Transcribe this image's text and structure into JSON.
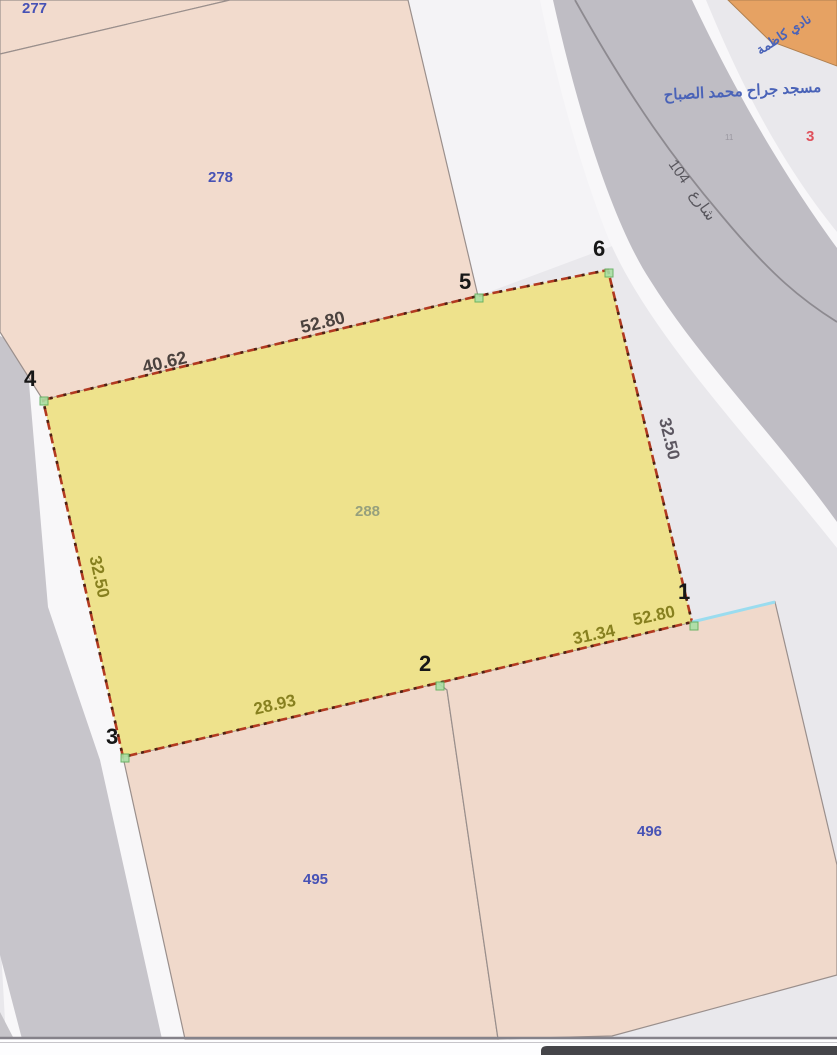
{
  "map": {
    "parcels": {
      "p277": {
        "label": "277"
      },
      "p278": {
        "label": "278"
      },
      "p288": {
        "label": "288"
      },
      "p495": {
        "label": "495"
      },
      "p496": {
        "label": "496"
      }
    },
    "selected_parcel": {
      "id": "288",
      "vertices": {
        "v1": "1",
        "v2": "2",
        "v3": "3",
        "v4": "4",
        "v5": "5",
        "v6": "6"
      },
      "dimensions": {
        "edge_4_5": "40.62",
        "edge_5_6": "52.80",
        "edge_6_1": "32.50",
        "edge_3_4": "32.50",
        "edge_2_3": "28.93",
        "edge_1_2": "31.34",
        "edge_right_lower": "52.80"
      }
    },
    "street": {
      "number": "104",
      "name_ar": "شارع"
    },
    "annotations": {
      "mosque_ar": "مسجد جراح محمد الصباح",
      "club_ar": "نادي كاظمة",
      "block_number": "3",
      "house_mark": "11"
    },
    "colors": {
      "background": "#e9e8ec",
      "sidewalk": "#f4f3f6",
      "road": "#bfbdc4",
      "road_left": "#c7c5cb",
      "parcel_pink": "#f2dbcd",
      "parcel_pink_dark": "#f0d9cb",
      "parcel_yellow": "#ede287",
      "boundary_red": "#b23a20",
      "boundary_dark": "#4d2013",
      "label_blue": "#4752b5",
      "label_gray_green": "#96a07d",
      "dim_dark": "#4b423e",
      "dim_gray": "#5b5660",
      "dim_olive": "#87801f",
      "marker_green": "#aadfa5",
      "marker_green_dark": "#5fae5c",
      "cyan_edge": "#9adcef",
      "orange_block": "#e6a263",
      "arabic_blue": "#4a63b8",
      "red_badge": "#e0515c"
    }
  }
}
